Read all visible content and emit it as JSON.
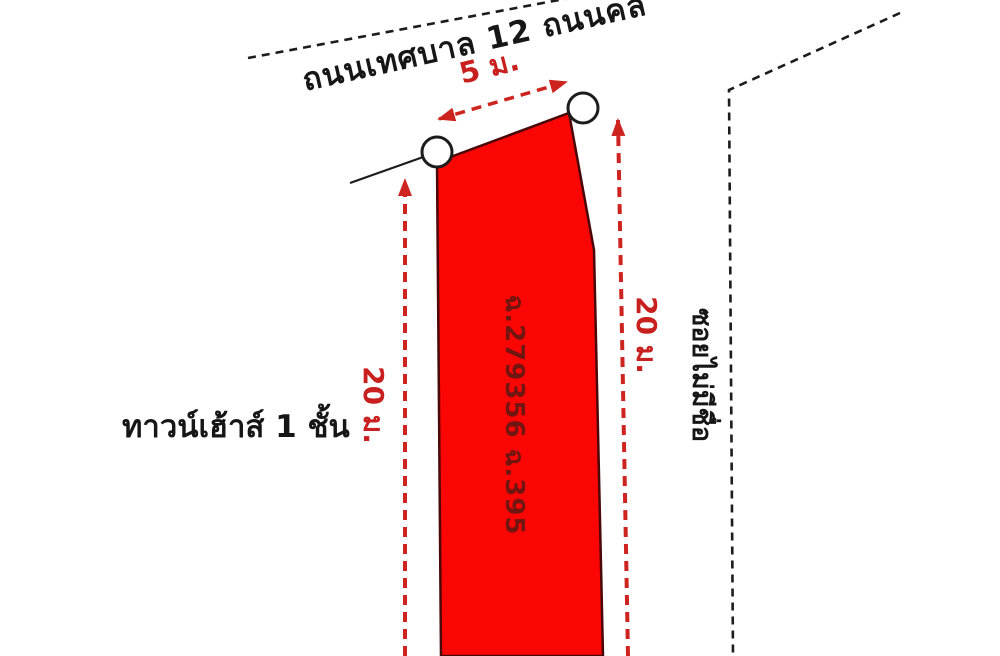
{
  "diagram": {
    "title_context": "land-plot-survey-sketch",
    "road_top": {
      "label": "ถนนเทศบาล 12 ถนนคล"
    },
    "soi_right": {
      "label": "ซอยไม่มีชื่อ"
    },
    "plot": {
      "deed_label": "ฉ.279356 ฉ.395",
      "width_label": "5 ม.",
      "depth_label_left": "20 ม.",
      "depth_label_right": "20 ม."
    },
    "neighbor": {
      "label": "ทาวน์เฮ้าส์ 1 ชั้น"
    },
    "colors": {
      "plot_fill": "#fb0505",
      "plot_border": "#4a0808",
      "dimension_red": "#ce2420",
      "dimension_text_red": "#c8201f",
      "deed_text": "#701510",
      "line_black": "#1c1c1c",
      "marker_fill": "#ffffff",
      "background": "#ffffff"
    }
  }
}
